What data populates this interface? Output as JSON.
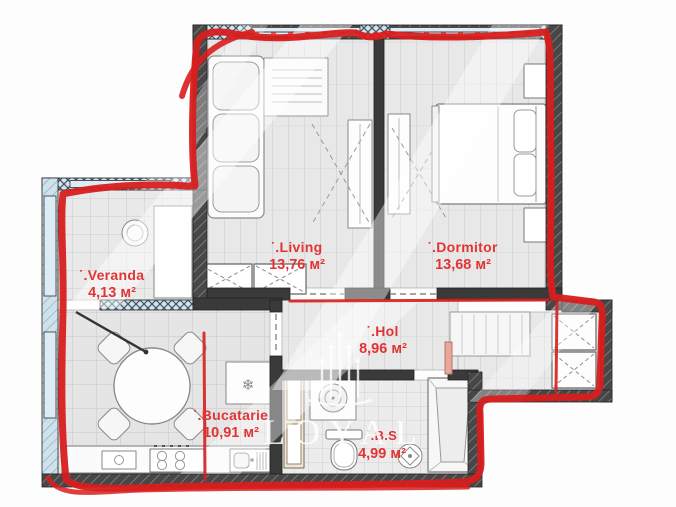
{
  "watermark": {
    "brand": "LOYAL"
  },
  "colors": {
    "annotation": "#d81e1e",
    "label": "#e23434",
    "watermark": "#ffffff"
  },
  "icons": {
    "bullet": "▪",
    "snowflake": "❄"
  },
  "rooms": [
    {
      "id": "living",
      "name": ".Living",
      "area": "13,76 м²"
    },
    {
      "id": "dormitor",
      "name": ".Dormitor",
      "area": "13,68 м²"
    },
    {
      "id": "veranda",
      "name": ".Veranda",
      "area": "4,13 м²"
    },
    {
      "id": "hol",
      "name": ".Hol",
      "area": "8,96 м²"
    },
    {
      "id": "bucatarie",
      "name": ".Bucatarie",
      "area": "10,91 м²"
    },
    {
      "id": "bs",
      "name": ".B.S",
      "area": "4,99 м²"
    }
  ]
}
